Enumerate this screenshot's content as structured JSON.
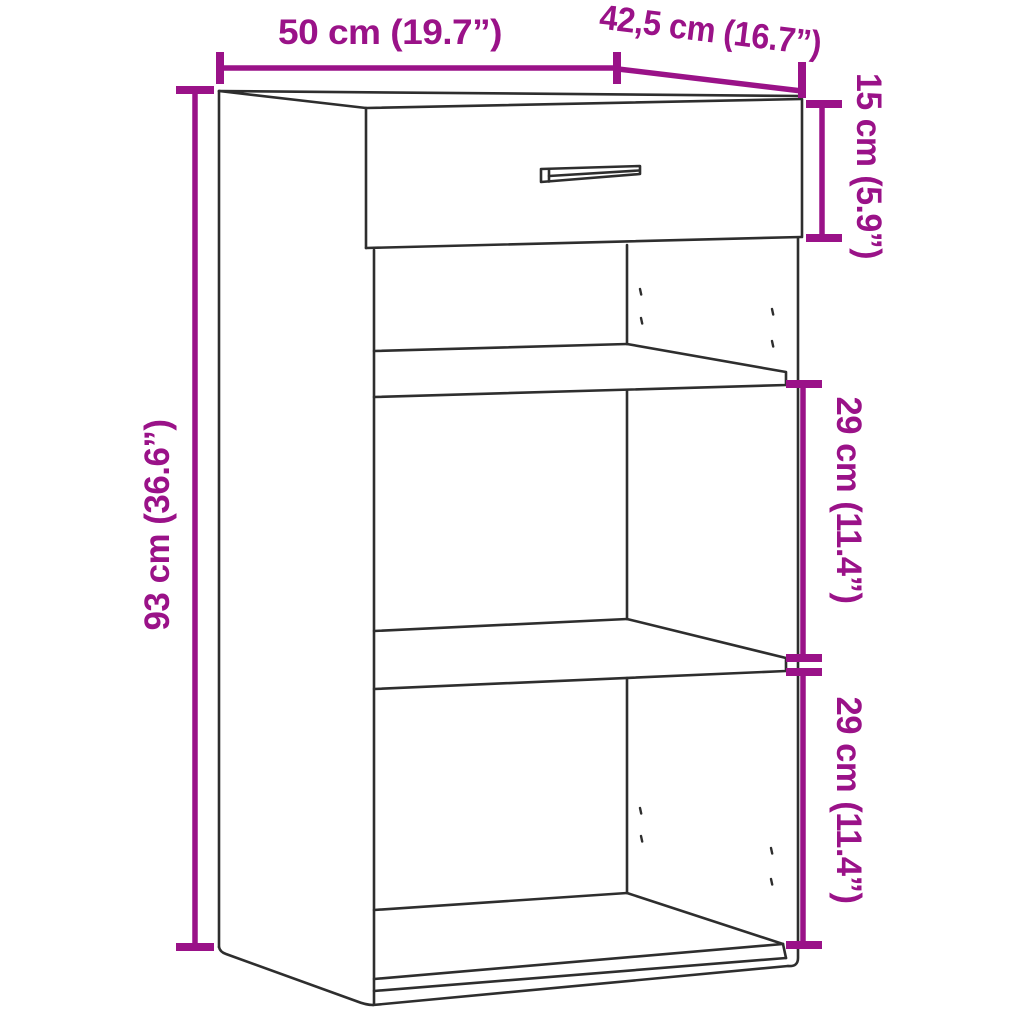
{
  "image": {
    "type": "furniture-dimension-diagram",
    "item": "Sideboard with top drawer and two open shelf compartments",
    "colors": {
      "dimension_accent": "#9a1288",
      "line_art": "#2e2e2e",
      "background": "#ffffff"
    },
    "dimensions": {
      "width": {
        "label": "50 cm (19.7”)",
        "cm": "50",
        "inches": "19.7"
      },
      "depth": {
        "label": "42,5 cm (16.7”)",
        "cm": "42,5",
        "inches": "16.7"
      },
      "drawer_height": {
        "label": "15 cm (5.9”)",
        "cm": "15",
        "inches": "5.9"
      },
      "total_height": {
        "label": "93 cm (36.6”)",
        "cm": "93",
        "inches": "36.6"
      },
      "upper_compartment_height": {
        "label": "29 cm (11.4”)",
        "cm": "29",
        "inches": "11.4"
      },
      "lower_compartment_height": {
        "label": "29 cm (11.4”)",
        "cm": "29",
        "inches": "11.4"
      }
    }
  }
}
